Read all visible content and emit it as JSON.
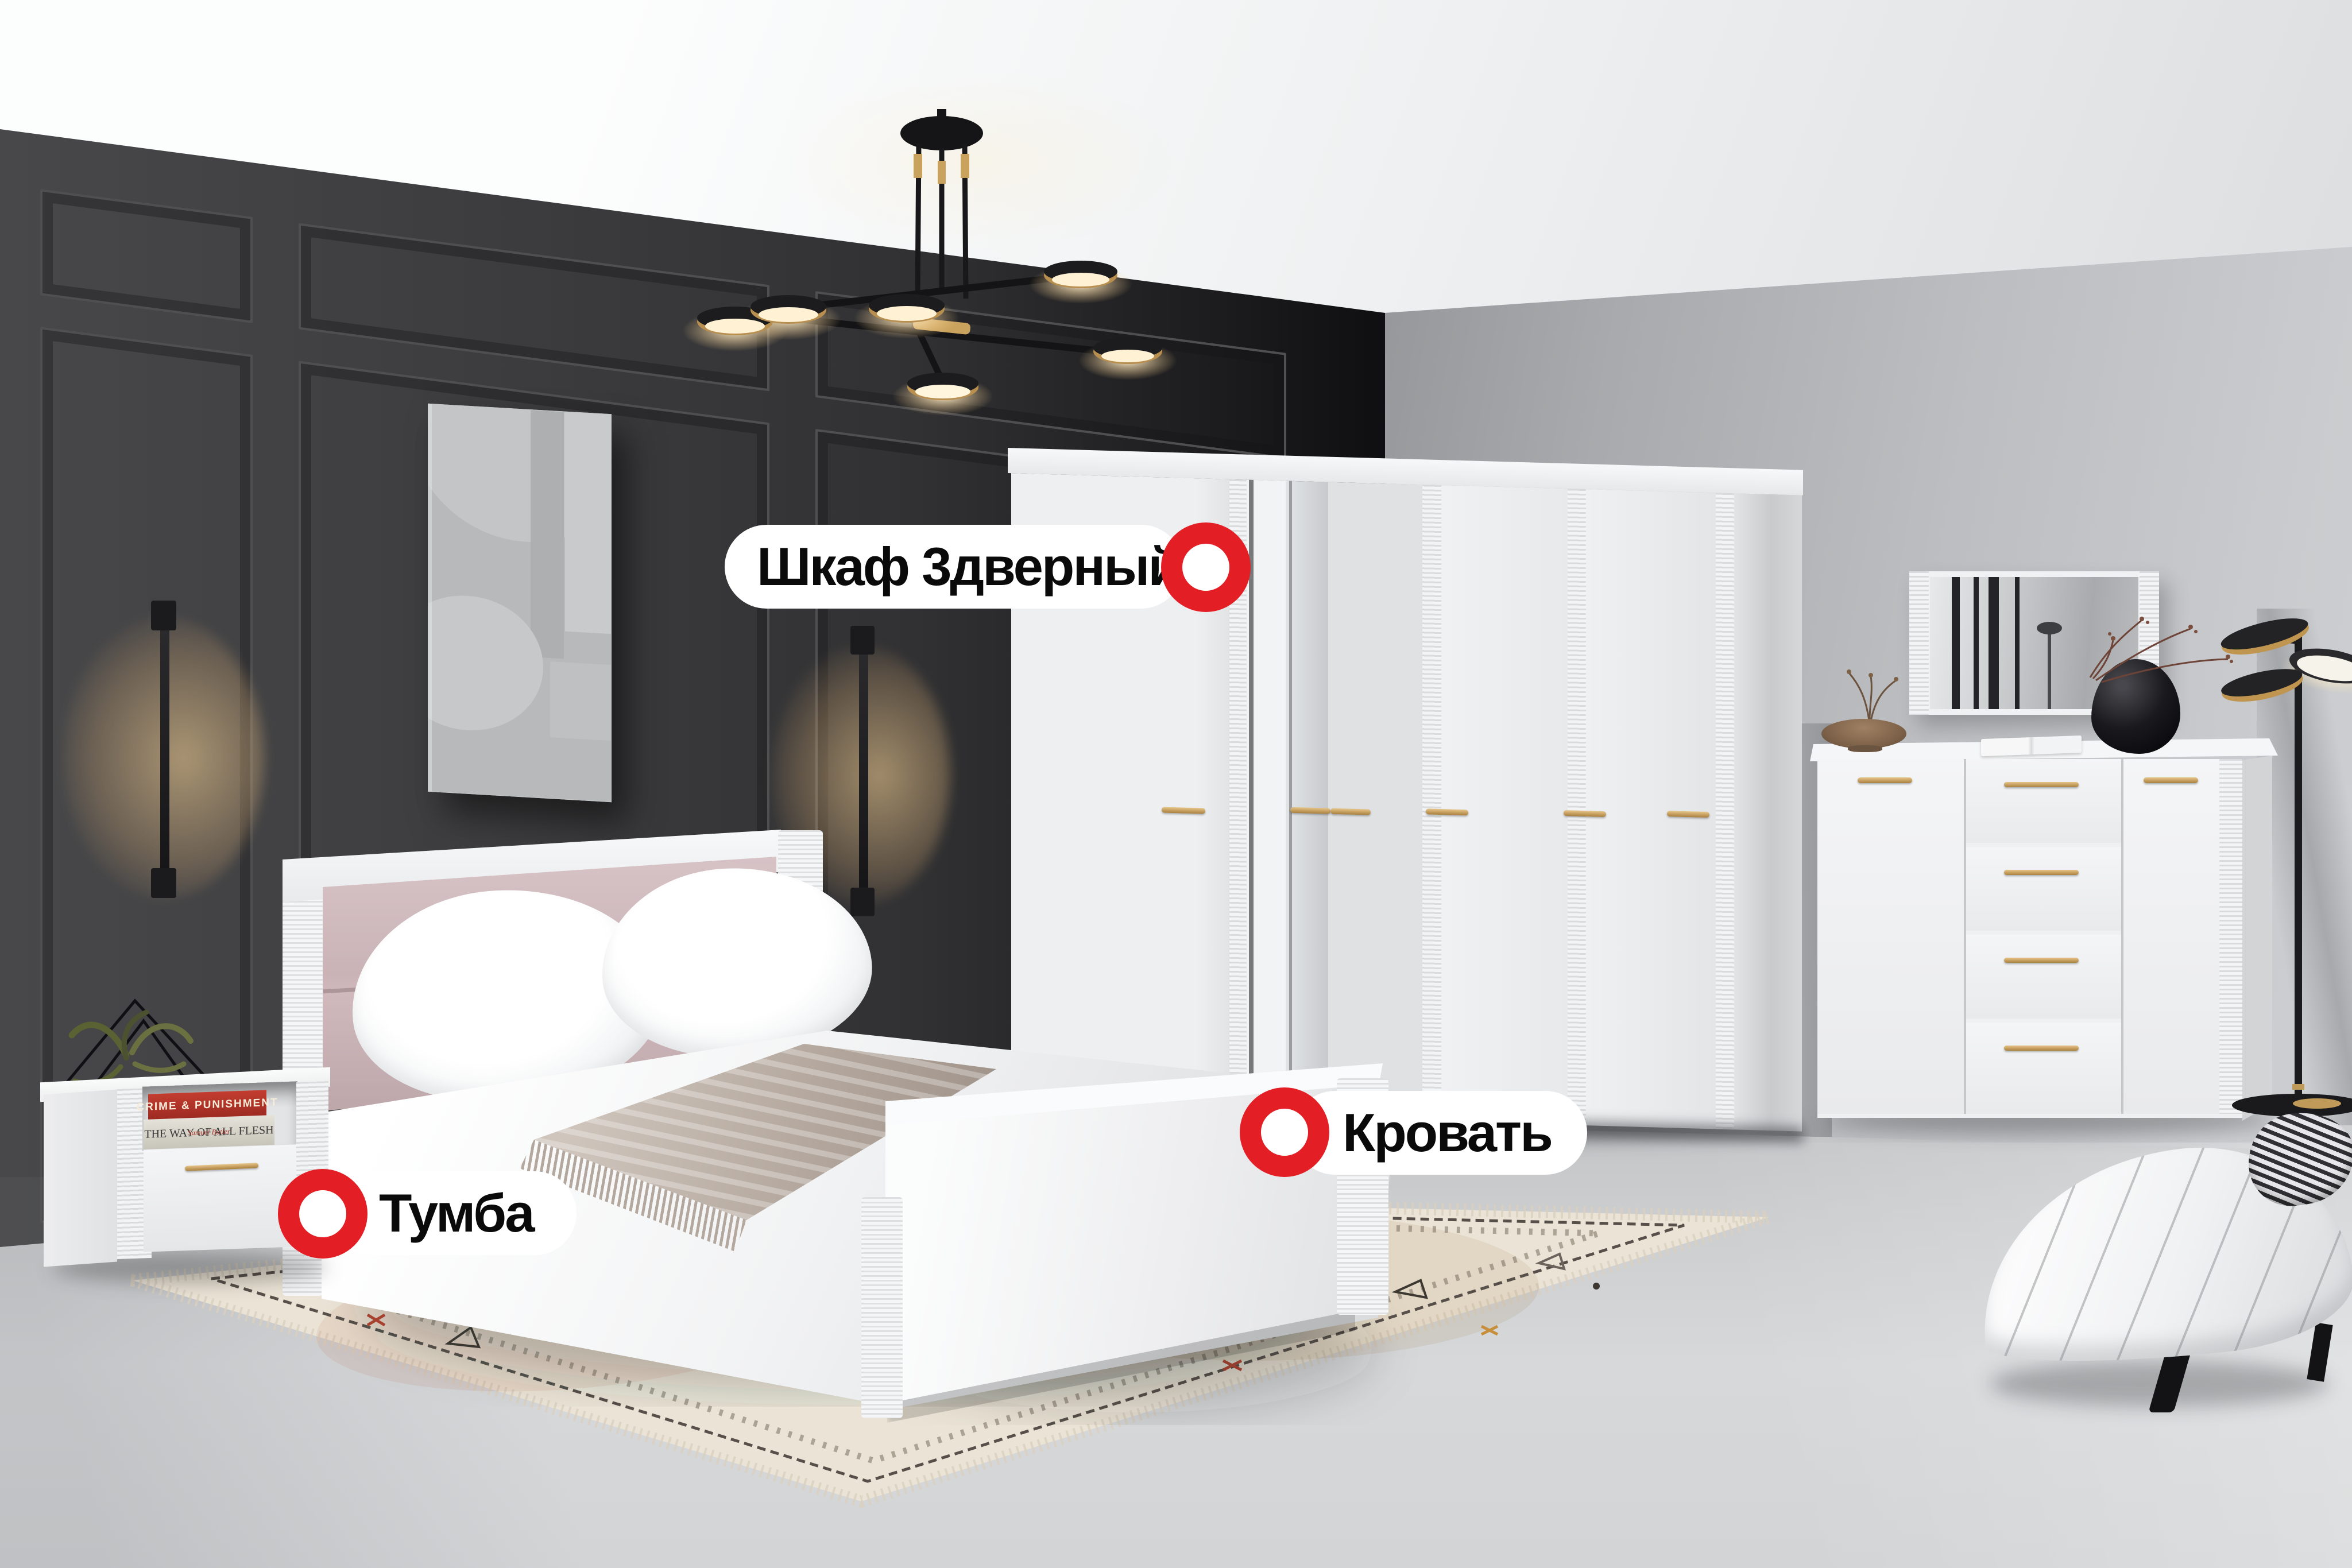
{
  "hotspots": {
    "wardrobe": {
      "label": "Шкаф 3дверный"
    },
    "bed": {
      "label": "Кровать"
    },
    "nightstand": {
      "label": "Тумба"
    }
  },
  "books": {
    "top": {
      "title": "CRIME & PUNISHMENT"
    },
    "bottom": {
      "title": "THE WAY OF ALL FLESH",
      "author": "Samuel Butler"
    }
  },
  "palette": {
    "marker_red": "#e31e24",
    "label_bg": "#ffffff",
    "label_text": "#0a0a0a",
    "gold": "#c2985a",
    "wall_dark": "#3a3a3c",
    "wall_gray": "#b9bbbe",
    "ceiling": "#f3f4f5",
    "floor": "#d0d2d4",
    "carpet": "#ebe4d6",
    "headboard_pink": "#ccb6b9",
    "book_red": "#b5352c",
    "throw_taupe": "#b3a79d"
  }
}
